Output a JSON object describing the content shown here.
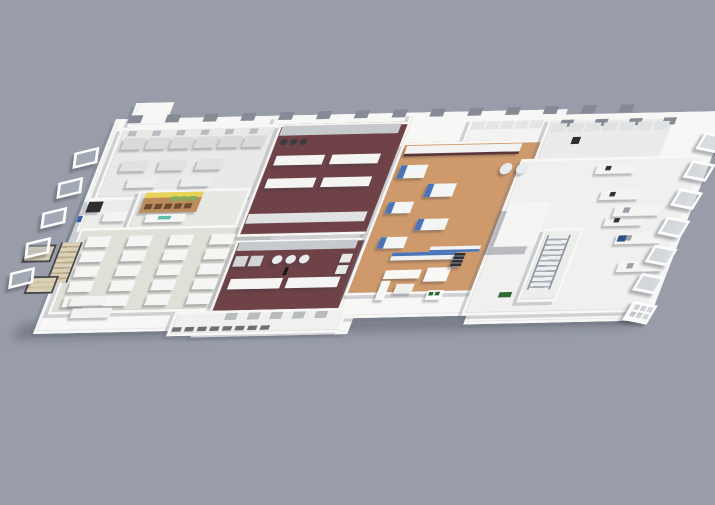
{
  "scene": {
    "type": "3d-isometric-floorplan-render",
    "background": "#989da9",
    "palette": {
      "bg": "#989da9",
      "wall": "#f7f7f6",
      "floorCafe": "#dfe0d8",
      "maroon": "#6e4247",
      "maroonDark": "#5c353b",
      "wood": "#cf9a6b",
      "steel": "#c7cacc",
      "blue": "#4a74b8",
      "blueDark": "#2b4f86",
      "yellow": "#e8d355",
      "woodShelf": "#b98d5e",
      "green": "#7fae5d",
      "greenDark": "#2f6b33",
      "teal": "#57bfa8",
      "dark": "#2e2e32",
      "beige": "#dbd0b6"
    },
    "plan": {
      "left": 118,
      "top": 114,
      "width": 700,
      "height": 260,
      "matrix": [
        0.9,
        -0.02,
        -0.34,
        0.88,
        0,
        0
      ]
    },
    "sections": [
      {
        "n": "ground-shadow",
        "x": -20,
        "y": 238,
        "w": 690,
        "h": 18,
        "cls": "gshadow"
      },
      {
        "n": "slab-left-wing",
        "x": 0,
        "y": 6,
        "w": 190,
        "h": 155,
        "c": "$wall"
      },
      {
        "n": "slab-left-front",
        "x": 0,
        "y": 92,
        "w": 230,
        "h": 152,
        "c": "$wall"
      },
      {
        "n": "slab-center",
        "x": 178,
        "y": 6,
        "w": 168,
        "h": 246,
        "c": "$wall"
      },
      {
        "n": "slab-right",
        "x": 328,
        "y": 6,
        "w": 168,
        "h": 228,
        "c": "$wall"
      },
      {
        "n": "slab-right-wing",
        "x": 478,
        "y": 12,
        "w": 200,
        "h": 232,
        "c": "$wall"
      },
      {
        "n": "back-gable",
        "x": 16,
        "y": -12,
        "w": 36,
        "h": 22,
        "c": "$wall"
      },
      {
        "n": "room-lab-northwest",
        "x": 10,
        "y": 16,
        "w": 172,
        "h": 76,
        "c": "#e9eae8"
      },
      {
        "n": "room-lab-west",
        "x": 4,
        "y": 96,
        "w": 54,
        "h": 52,
        "c": "#ececea"
      },
      {
        "n": "room-retail",
        "x": 58,
        "y": 88,
        "w": 118,
        "h": 50,
        "c": "#e7e7e3"
      },
      {
        "n": "room-cafeteria",
        "x": 8,
        "y": 130,
        "w": 214,
        "h": 92,
        "c": "$floorCafe"
      },
      {
        "n": "room-kitchen-north",
        "x": 186,
        "y": 16,
        "w": 140,
        "h": 122,
        "c": "$maroon",
        "cls": "tiles"
      },
      {
        "n": "room-kitchen-south",
        "x": 188,
        "y": 148,
        "w": 140,
        "h": 82,
        "c": "$maroon",
        "cls": "tiles"
      },
      {
        "n": "room-serving",
        "x": 150,
        "y": 228,
        "w": 186,
        "h": 22,
        "c": "#f0f0ee"
      },
      {
        "n": "room-glass-lab",
        "x": 398,
        "y": 14,
        "w": 84,
        "h": 30,
        "c": "#f2f3f2"
      },
      {
        "n": "room-processing",
        "x": 332,
        "y": 40,
        "w": 152,
        "h": 168,
        "c": "$wood",
        "cls": "planks"
      },
      {
        "n": "room-right-lab",
        "x": 486,
        "y": 16,
        "w": 136,
        "h": 54,
        "c": "#ebebea"
      },
      {
        "n": "room-hall",
        "x": 472,
        "y": 62,
        "w": 200,
        "h": 172,
        "c": "#f0f0ef"
      },
      {
        "n": "room-stair",
        "x": 528,
        "y": 142,
        "w": 38,
        "h": 78,
        "c": "#ededec"
      }
    ],
    "items": [
      {
        "n": "back-window",
        "x": 14,
        "y": 2,
        "w": 15,
        "h": 9,
        "c": "#858a94",
        "cols": 14,
        "dx": 42
      },
      {
        "n": "back-window-right",
        "x": 500,
        "y": 18,
        "w": 14,
        "h": 8,
        "c": "#858a94",
        "cols": 4,
        "dx": 38
      },
      {
        "n": "lab-wall-units",
        "x": 20,
        "y": 20,
        "w": 9,
        "h": 6,
        "c": "#b9bdc2",
        "cols": 6,
        "dx": 27
      },
      {
        "n": "lab-bench",
        "x": 18,
        "y": 28,
        "w": 24,
        "h": 13,
        "c": "#d9dbdb",
        "cols": 6,
        "dx": 27,
        "sh": 1
      },
      {
        "n": "lab-table",
        "x": 26,
        "y": 54,
        "w": 30,
        "h": 12,
        "c": "#e0e2e2",
        "cols": 3,
        "dx": 42,
        "sh": 1
      },
      {
        "n": "lab-table-2",
        "x": 40,
        "y": 74,
        "w": 34,
        "h": 11,
        "c": "#eceded",
        "cols": 2,
        "dx": 60,
        "sh": 1
      },
      {
        "n": "appliance-dark",
        "x": 6,
        "y": 100,
        "w": 16,
        "h": 12,
        "c": "$dark",
        "sh": 1
      },
      {
        "n": "wall-sign-blue",
        "x": 0,
        "y": 116,
        "w": 5,
        "h": 7,
        "c": "#3a5fa8"
      },
      {
        "n": "west-bench",
        "x": 28,
        "y": 112,
        "w": 26,
        "h": 11,
        "c": "#f3f3f1",
        "sh": 1
      },
      {
        "n": "retail-shelf",
        "x": 66,
        "y": 94,
        "w": 64,
        "h": 20,
        "c": "$woodShelf",
        "sh": 1
      },
      {
        "n": "retail-shelf-top",
        "x": 66,
        "y": 91,
        "w": 64,
        "h": 6,
        "c": "$yellow"
      },
      {
        "n": "retail-crates-brown",
        "x": 70,
        "y": 104,
        "w": 8,
        "h": 6,
        "c": "#6f4a2e",
        "cols": 5,
        "dx": 11
      },
      {
        "n": "retail-crates-green",
        "x": 96,
        "y": 96,
        "w": 8,
        "h": 5,
        "c": "$green",
        "cols": 3,
        "dx": 10
      },
      {
        "n": "retail-counter",
        "x": 76,
        "y": 116,
        "w": 44,
        "h": 9,
        "c": "#f6f6f4",
        "sh": 1
      },
      {
        "n": "brand-logo",
        "x": 90,
        "y": 118,
        "w": 14,
        "h": 4,
        "c": "$teal"
      },
      {
        "n": "cafeteria-table",
        "x": 20,
        "y": 140,
        "w": 26,
        "h": 12,
        "c": "#f5f5f3",
        "cols": 4,
        "rows": 5,
        "dx": 46,
        "dy": 17,
        "sh": 1
      },
      {
        "n": "servery-counter",
        "x": 28,
        "y": 208,
        "w": 38,
        "h": 11,
        "c": "#f2f2f0",
        "sh": 1
      },
      {
        "n": "servery-counter-2",
        "x": 34,
        "y": 222,
        "w": 44,
        "h": 11,
        "c": "#f2f2f0",
        "sh": 1
      },
      {
        "n": "stair-left",
        "x": -8,
        "y": 146,
        "w": 20,
        "h": 46,
        "cls": "stairs-beige"
      },
      {
        "n": "balcony",
        "x": -44,
        "y": 148,
        "w": 28,
        "h": 16,
        "cls": "balcony"
      },
      {
        "n": "balcony-2",
        "x": -28,
        "y": 184,
        "w": 28,
        "h": 16,
        "cls": "balcony"
      },
      {
        "n": "window-frame-left",
        "x": -30,
        "y": 40,
        "w": 20,
        "h": 13,
        "cls": "frame",
        "r": -14,
        "rows": 5,
        "dy": 34,
        "rdx": -5
      },
      {
        "n": "cookline-north",
        "x": 190,
        "y": 18,
        "w": 132,
        "h": 11,
        "c": "$steel"
      },
      {
        "n": "stock-pots",
        "x": 194,
        "y": 33,
        "w": 8,
        "h": 7,
        "c": "#3c3c40",
        "cols": 3,
        "dx": 11,
        "round": 1
      },
      {
        "n": "prep-table",
        "x": 196,
        "y": 52,
        "w": 54,
        "h": 11,
        "c": "#f4f4f2",
        "cols": 2,
        "rows": 2,
        "dx": 62,
        "dy": 26,
        "sh": 1
      },
      {
        "n": "cookline-north-b",
        "x": 190,
        "y": 118,
        "w": 132,
        "h": 11,
        "c": "#dfe1e2"
      },
      {
        "n": "cookline-south",
        "x": 192,
        "y": 150,
        "w": 132,
        "h": 10,
        "c": "$steel"
      },
      {
        "n": "combi-oven",
        "x": 194,
        "y": 166,
        "w": 14,
        "h": 12,
        "c": "#d2d4d6",
        "cols": 2,
        "dx": 17,
        "sh": 1
      },
      {
        "n": "steam-kettle",
        "x": 236,
        "y": 166,
        "w": 11,
        "h": 10,
        "c": "#e9eaeb",
        "cols": 3,
        "dx": 15,
        "round": 1,
        "sh": 1
      },
      {
        "n": "island-counter",
        "x": 198,
        "y": 192,
        "w": 58,
        "h": 12,
        "c": "#f4f4f2",
        "sh": 1
      },
      {
        "n": "island-counter-2",
        "x": 262,
        "y": 192,
        "w": 58,
        "h": 12,
        "c": "#f4f4f2",
        "sh": 1
      },
      {
        "n": "fridges",
        "x": 312,
        "y": 166,
        "w": 12,
        "h": 10,
        "c": "#e6e7e8",
        "rows": 2,
        "dy": 13,
        "sh": 1
      },
      {
        "n": "person",
        "x": 254,
        "y": 180,
        "w": 4,
        "h": 9,
        "c": "#17171a"
      },
      {
        "n": "serving-equipment",
        "x": 208,
        "y": 231,
        "w": 13,
        "h": 8,
        "c": "#b9bcbf",
        "cols": 5,
        "dx": 25
      },
      {
        "n": "pass-shelf",
        "x": 154,
        "y": 246,
        "w": 10,
        "h": 5,
        "c": "#6e6e74",
        "cols": 8,
        "dx": 14
      },
      {
        "n": "glass-lab-bench",
        "x": 402,
        "y": 18,
        "w": 14,
        "h": 9,
        "c": "#e4e5e6",
        "cols": 5,
        "dx": 16
      },
      {
        "n": "processing-bench-back",
        "x": 338,
        "y": 44,
        "w": 128,
        "h": 11,
        "c": "#f2f2f2",
        "sh": 1
      },
      {
        "n": "bench-kick",
        "x": 338,
        "y": 53,
        "w": 128,
        "h": 3,
        "c": "$maroonDark"
      },
      {
        "n": "process-machine",
        "x": 340,
        "y": 66,
        "w": 30,
        "h": 15,
        "c": "#f3f4f4",
        "sh": 1
      },
      {
        "n": "machine-panel",
        "x": 340,
        "y": 66,
        "w": 7,
        "h": 15,
        "c": "$blue"
      },
      {
        "n": "process-machine-2",
        "x": 378,
        "y": 88,
        "w": 32,
        "h": 15,
        "c": "#f3f4f4",
        "sh": 1
      },
      {
        "n": "machine-panel-2",
        "x": 378,
        "y": 88,
        "w": 7,
        "h": 15,
        "c": "$blue"
      },
      {
        "n": "process-machine-3",
        "x": 342,
        "y": 108,
        "w": 28,
        "h": 13,
        "c": "#f3f4f4",
        "sh": 1
      },
      {
        "n": "machine-panel-3",
        "x": 342,
        "y": 108,
        "w": 7,
        "h": 13,
        "c": "$blue"
      },
      {
        "n": "process-machine-4",
        "x": 382,
        "y": 128,
        "w": 34,
        "h": 13,
        "c": "#f3f4f4",
        "sh": 1
      },
      {
        "n": "machine-panel-4",
        "x": 382,
        "y": 128,
        "w": 7,
        "h": 13,
        "c": "$blue"
      },
      {
        "n": "process-machine-5",
        "x": 348,
        "y": 148,
        "w": 30,
        "h": 13,
        "c": "#f3f4f4",
        "sh": 1
      },
      {
        "n": "machine-panel-5",
        "x": 348,
        "y": 148,
        "w": 7,
        "h": 13,
        "c": "$blue"
      },
      {
        "n": "conveyor",
        "x": 368,
        "y": 166,
        "w": 72,
        "h": 9,
        "c": "#eef0f2",
        "sh": 1
      },
      {
        "n": "conveyor-belt",
        "x": 368,
        "y": 166,
        "w": 72,
        "h": 4,
        "c": "$blue"
      },
      {
        "n": "mixing-tank",
        "x": 452,
        "y": 66,
        "w": 13,
        "h": 13,
        "c": "#e8eaec",
        "cols": 2,
        "dx": 18,
        "round": 1,
        "sh": 1
      },
      {
        "n": "blue-bench",
        "x": 408,
        "y": 160,
        "w": 56,
        "h": 7,
        "c": "#f2f3f4"
      },
      {
        "n": "blue-bench-panel",
        "x": 408,
        "y": 164,
        "w": 56,
        "h": 3,
        "c": "$blue"
      },
      {
        "n": "sofa",
        "x": 368,
        "y": 186,
        "w": 40,
        "h": 10,
        "c": "#f7f7f5",
        "sh": 1
      },
      {
        "n": "sofa-2",
        "x": 368,
        "y": 198,
        "w": 10,
        "h": 22,
        "c": "#f7f7f5",
        "sh": 1
      },
      {
        "n": "coffee-table",
        "x": 386,
        "y": 202,
        "w": 20,
        "h": 11,
        "c": "#efefed",
        "sh": 1
      },
      {
        "n": "meeting-table",
        "x": 414,
        "y": 184,
        "w": 26,
        "h": 16,
        "c": "#f8f8f6",
        "sh": 1
      },
      {
        "n": "tray-rack",
        "x": 438,
        "y": 168,
        "w": 12,
        "h": 16,
        "cls": "rack",
        "sh": 1
      },
      {
        "n": "service-cart",
        "x": 424,
        "y": 210,
        "w": 18,
        "h": 11,
        "c": "#fbfbfa",
        "sh": 1
      },
      {
        "n": "cart-tray",
        "x": 426,
        "y": 212,
        "w": 5,
        "h": 4,
        "c": "$greenDark",
        "cols": 2,
        "dx": 7
      },
      {
        "n": "analyzer",
        "x": 492,
        "y": 22,
        "w": 16,
        "h": 10,
        "c": "#e1e2e3",
        "cols": 7,
        "dx": 19
      },
      {
        "n": "robot-arm",
        "x": 520,
        "y": 38,
        "w": 9,
        "h": 8,
        "c": "$dark"
      },
      {
        "n": "desk-row",
        "x": 560,
        "y": 70,
        "w": 44,
        "h": 11,
        "c": "#f3f3f1",
        "rows": 3,
        "dy": 30,
        "rdx": 16,
        "sh": 1
      },
      {
        "n": "desk-equipment",
        "x": 570,
        "y": 72,
        "w": 6,
        "h": 5,
        "c": "#31343a",
        "rows": 3,
        "dy": 30,
        "rdx": 16
      },
      {
        "n": "elevator-shaft",
        "x": 478,
        "y": 112,
        "w": 46,
        "h": 50,
        "c": "#f5f5f4",
        "cls": "tall"
      },
      {
        "n": "stair-right",
        "x": 534,
        "y": 150,
        "w": 22,
        "h": 62,
        "cls": "stairs-steel"
      },
      {
        "n": "hall-bench",
        "x": 598,
        "y": 118,
        "w": 52,
        "h": 12,
        "c": "#f4f4f2",
        "rows": 3,
        "dy": 32,
        "rdx": 14,
        "sh": 1
      },
      {
        "n": "bench-instrument",
        "x": 608,
        "y": 120,
        "w": 7,
        "h": 6,
        "c": "#9aa0a8",
        "rows": 3,
        "dy": 32,
        "rdx": 14
      },
      {
        "n": "instrument-blue",
        "x": 614,
        "y": 152,
        "w": 9,
        "h": 7,
        "c": "$blueDark"
      },
      {
        "n": "green-crate",
        "x": 505,
        "y": 214,
        "w": 14,
        "h": 6,
        "c": "$greenDark"
      },
      {
        "n": "window-frame-right",
        "x": 664,
        "y": 38,
        "w": 22,
        "h": 14,
        "cls": "frame",
        "r": 12,
        "rows": 6,
        "dy": 32,
        "rdx": -2
      },
      {
        "n": "window-frame-grid",
        "x": 656,
        "y": 230,
        "w": 24,
        "h": 16,
        "cls": "frame frame-grid",
        "r": 12
      }
    ]
  }
}
